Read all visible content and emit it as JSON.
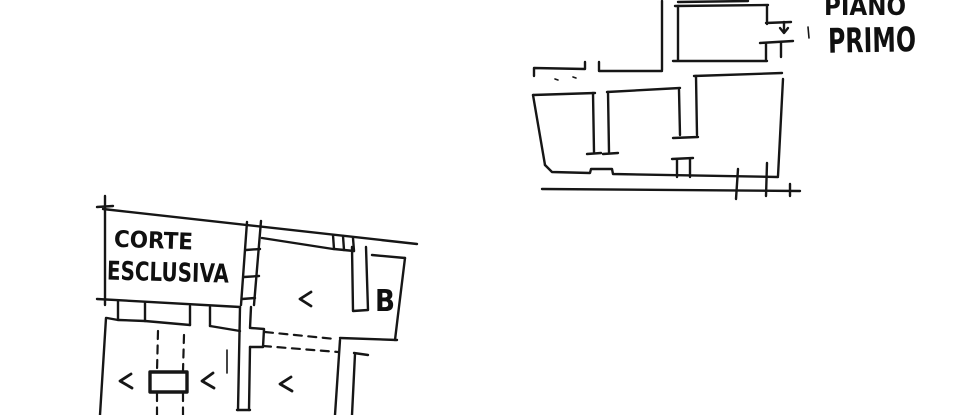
{
  "canvas": {
    "width": 960,
    "height": 415,
    "background": "#ffffff",
    "ink": "#161616"
  },
  "annotations": {
    "floor_label": {
      "line1": "PIANO",
      "line2": "PRIMO"
    },
    "courtyard_label": {
      "line1": "CORTE",
      "line2": "ESCLUSIVA"
    },
    "room_label_b": "B",
    "room_marks_count": 4
  },
  "drawing": {
    "upper_plan": {
      "walls": [
        [
          662,
          1,
          662,
          70
        ],
        [
          534,
          76,
          534,
          68,
          585,
          69,
          585,
          62
        ],
        [
          599,
          62,
          599,
          71,
          662,
          71
        ],
        [
          678,
          2,
          748,
          1
        ],
        [
          675,
          6,
          768,
          5
        ],
        [
          678,
          6,
          678,
          60
        ],
        [
          673,
          61,
          767,
          61
        ],
        [
          767,
          6,
          767,
          24
        ],
        [
          766,
          23,
          791,
          22
        ],
        [
          784,
          22,
          784,
          32
        ],
        [
          780,
          28,
          784,
          33,
          788,
          28
        ],
        [
          760,
          43,
          793,
          41
        ],
        [
          781,
          42,
          781,
          57
        ],
        [
          766,
          44,
          766,
          60
        ],
        [
          694,
          76,
          782,
          73
        ],
        [
          696,
          76,
          697,
          135
        ],
        [
          673,
          138,
          698,
          137
        ],
        [
          679,
          90,
          680,
          135
        ],
        [
          607,
          92,
          680,
          88
        ],
        [
          533,
          95,
          595,
          93
        ],
        [
          593,
          93,
          594,
          152
        ],
        [
          587,
          154,
          601,
          153
        ],
        [
          608,
          92,
          609,
          152
        ],
        [
          603,
          154,
          618,
          153
        ],
        [
          533,
          95,
          545,
          165
        ],
        [
          545,
          165,
          552,
          172,
          590,
          173,
          591,
          169,
          612,
          169,
          613,
          174,
          778,
          177
        ],
        [
          783,
          79,
          778,
          176
        ],
        [
          672,
          159,
          693,
          158
        ],
        [
          677,
          160,
          677,
          177
        ],
        [
          690,
          159,
          690,
          177
        ],
        [
          542,
          189,
          800,
          191
        ],
        [
          738,
          169,
          736,
          199
        ],
        [
          767,
          163,
          766,
          196
        ],
        [
          790,
          184,
          790,
          196
        ]
      ],
      "thin": [
        [
          555,
          79,
          558,
          80
        ],
        [
          573,
          77,
          576,
          78
        ],
        [
          808,
          27,
          809,
          38
        ]
      ],
      "dashed": [],
      "thick": [],
      "marks": []
    },
    "lower_plan": {
      "walls": [
        [
          103,
          209,
          417,
          244
        ],
        [
          105,
          196,
          105,
          305
        ],
        [
          97,
          207,
          113,
          206
        ],
        [
          97,
          299,
          240,
          307
        ],
        [
          247,
          222,
          241,
          305
        ],
        [
          261,
          221,
          254,
          305
        ],
        [
          246,
          250,
          260,
          249
        ],
        [
          244,
          277,
          259,
          276
        ],
        [
          242,
          299,
          255,
          298
        ],
        [
          240,
          307,
          238,
          410
        ],
        [
          251,
          307,
          250,
          328
        ],
        [
          251,
          328,
          264,
          329,
          263,
          347,
          250,
          347
        ],
        [
          250,
          347,
          249,
          410
        ],
        [
          237,
          410,
          250,
          410
        ],
        [
          262,
          238,
          333,
          249
        ],
        [
          333,
          235,
          334,
          249
        ],
        [
          334,
          249,
          354,
          251
        ],
        [
          343,
          236,
          344,
          250
        ],
        [
          353,
          238,
          354,
          251
        ],
        [
          352,
          247,
          353,
          311,
          368,
          310,
          366,
          247
        ],
        [
          372,
          255,
          405,
          258
        ],
        [
          405,
          258,
          398,
          315,
          395,
          340
        ],
        [
          340,
          338,
          397,
          340
        ],
        [
          340,
          340,
          335,
          415
        ],
        [
          354,
          353,
          368,
          355
        ],
        [
          355,
          354,
          352,
          415
        ],
        [
          107,
          318,
          118,
          320
        ],
        [
          118,
          301,
          118,
          320
        ],
        [
          145,
          303,
          145,
          321
        ],
        [
          119,
          320,
          145,
          321
        ],
        [
          145,
          321,
          190,
          325
        ],
        [
          190,
          306,
          190,
          325
        ],
        [
          210,
          307,
          210,
          326
        ],
        [
          210,
          326,
          240,
          331
        ],
        [
          106,
          318,
          100,
          415
        ]
      ],
      "thin": [
        [
          227,
          350,
          227,
          373
        ]
      ],
      "thick": [
        [
          150,
          372,
          187,
          372,
          187,
          392,
          150,
          392,
          150,
          372
        ]
      ],
      "dashed": [
        [
          265,
          332,
          335,
          339
        ],
        [
          263,
          346,
          338,
          352
        ],
        [
          158,
          331,
          157,
          371
        ],
        [
          157,
          393,
          157,
          415
        ],
        [
          184,
          335,
          183,
          371
        ],
        [
          183,
          393,
          183,
          415
        ]
      ],
      "marks": [
        [
          311,
          292,
          300,
          299,
          311,
          306
        ],
        [
          131,
          374,
          120,
          381,
          132,
          388
        ],
        [
          213,
          373,
          202,
          381,
          214,
          388
        ],
        [
          291,
          377,
          280,
          384,
          292,
          391
        ]
      ]
    }
  }
}
